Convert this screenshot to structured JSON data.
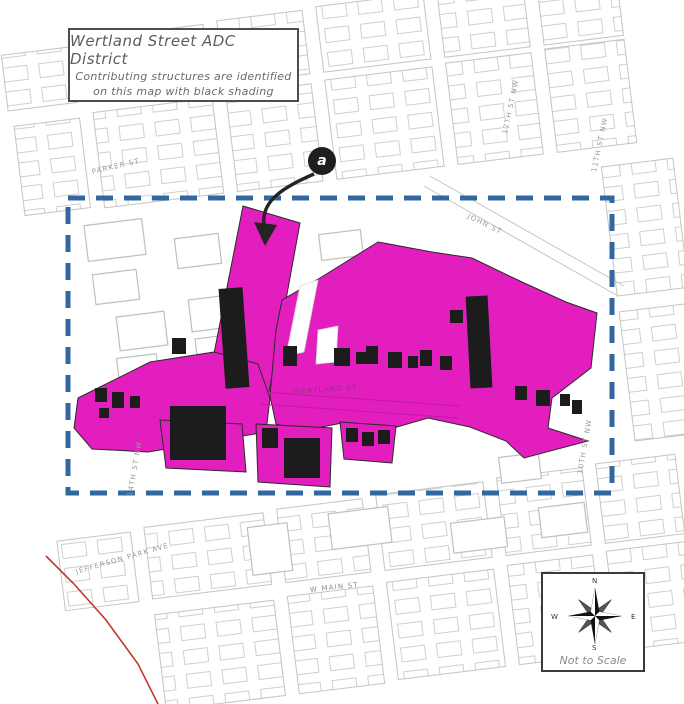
{
  "title_box": {
    "line1": "Wertland Street ADC District",
    "line2": "Contributing structures are identified",
    "line3": "on this map with black shading"
  },
  "marker": {
    "label": "a"
  },
  "compass": {
    "n": "N",
    "e": "E",
    "s": "S",
    "w": "W",
    "caption": "Not to Scale"
  },
  "street_labels": [
    {
      "id": "parker",
      "text": "PARKER ST"
    },
    {
      "id": "john",
      "text": "JOHN ST"
    },
    {
      "id": "wertland",
      "text": "WERTLAND ST"
    },
    {
      "id": "w-main",
      "text": "W MAIN ST"
    },
    {
      "id": "jefferson",
      "text": "JEFFERSON PARK AVE"
    },
    {
      "id": "14th-nw",
      "text": "14TH ST NW"
    },
    {
      "id": "12th-nw",
      "text": "12TH ST NW"
    },
    {
      "id": "11th-nw",
      "text": "11TH ST NW"
    },
    {
      "id": "10th-nw",
      "text": "10TH ST NW"
    }
  ],
  "legend": {
    "district_color": "#E21FBE",
    "boundary_color": "#33679F",
    "contributing_color": "#1C1C1C",
    "basemap_line_color": "#C9C9C9",
    "railroad_color": "#C0392B"
  }
}
